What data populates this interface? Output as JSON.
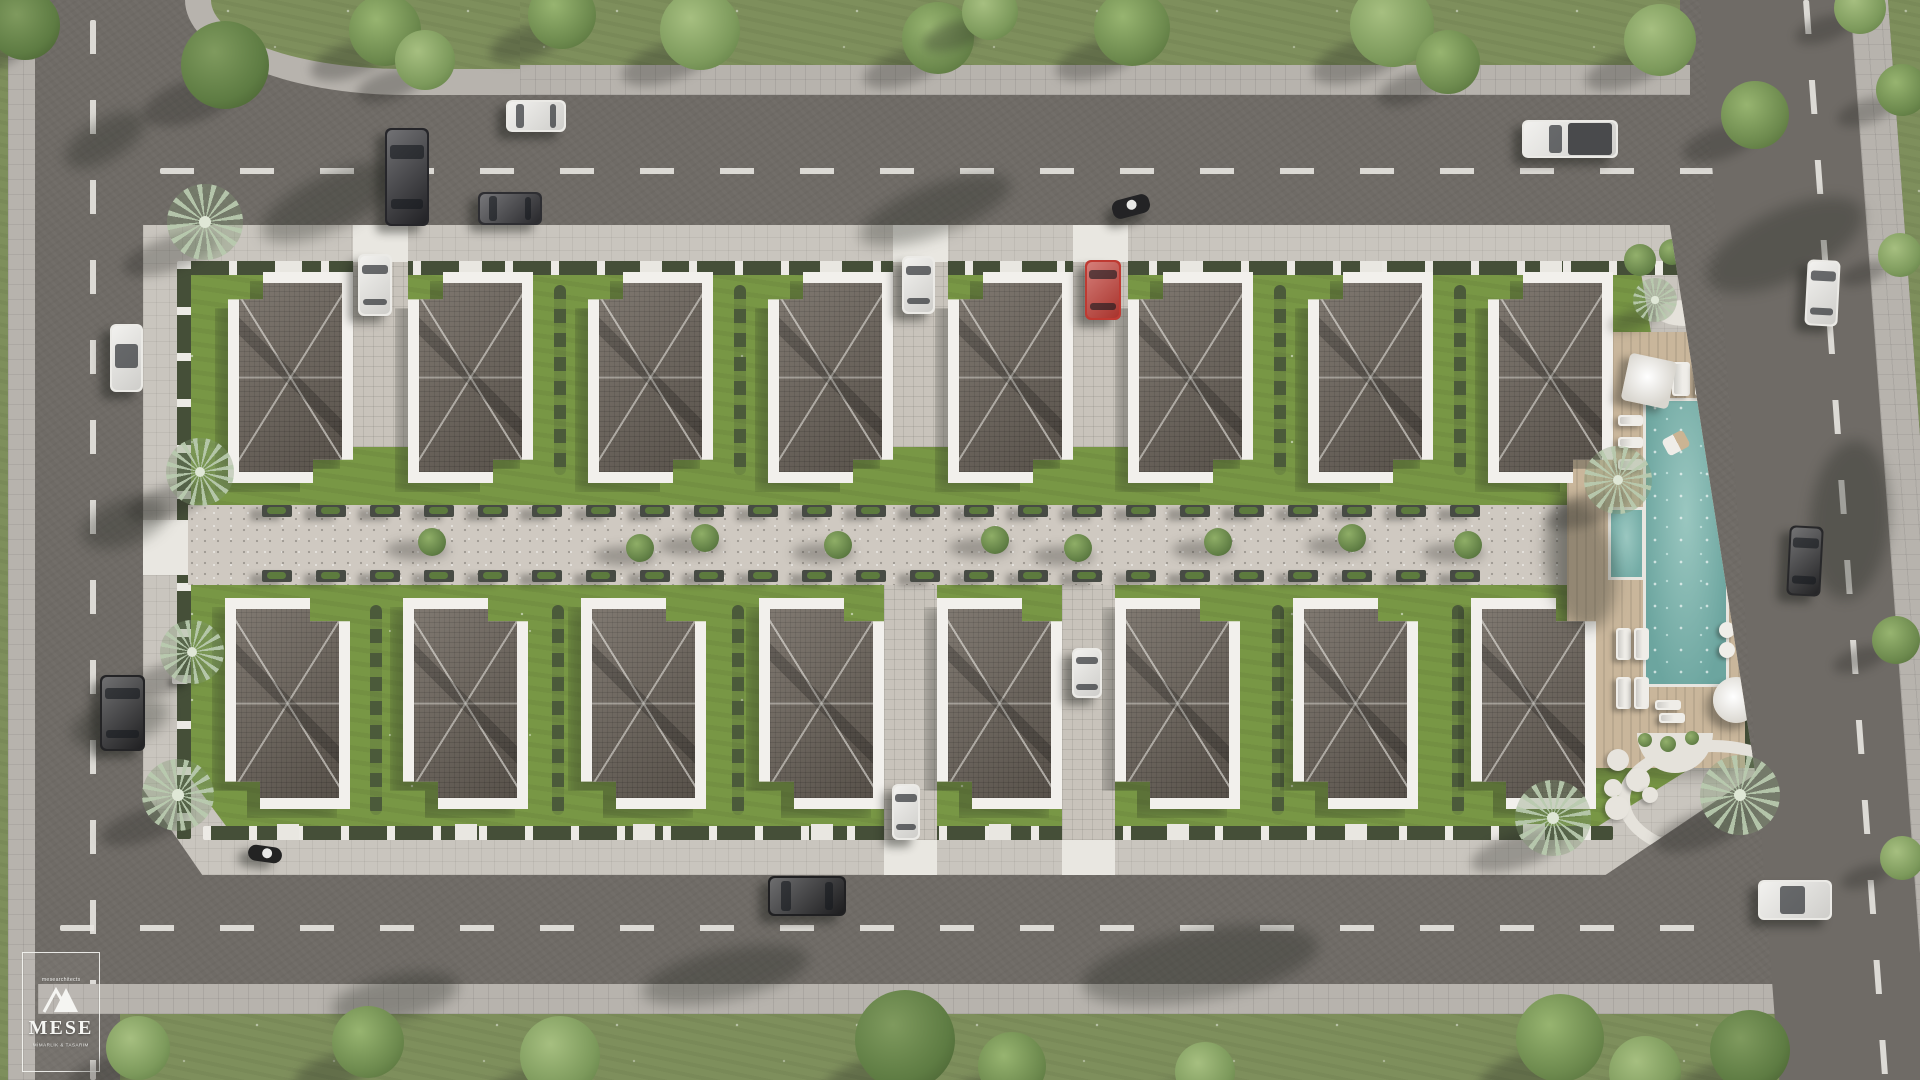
{
  "watermark": {
    "header": "mesearchitects",
    "brand": "MESE",
    "tagline": "MİMARLIK & TASARIM"
  },
  "palette": {
    "asphalt": "#6f6b66",
    "road_dash": "#e8e6e1",
    "sidewalk": "#b7b3ad",
    "ring_sidewalk": "#c9c5be",
    "grass_outer": "#7e8f5c",
    "lawn": "#789745",
    "hedge": "#454f38",
    "fence_post": "#eceae5",
    "roof": "#6e665d",
    "parapet": "#f2f0ec",
    "walkway": "#cfc9c1",
    "planter": "#474b44",
    "deck_wood": "#c9b69b",
    "pool_water": "#7db1ab",
    "car_white": "#ebeae6",
    "car_black": "#26262a",
    "car_red": "#bf3a32",
    "tree_green": "#6d8a4e",
    "palm_green": "#b7c9ad",
    "shadow": "rgba(35,38,32,0.32)"
  },
  "scene": {
    "villas": {
      "w": 125,
      "h": 211,
      "top_row": {
        "y": 272,
        "xs": [
          228,
          408,
          588,
          768,
          948,
          1128,
          1308,
          1488
        ]
      },
      "bottom_row": {
        "y": 598,
        "xs": [
          225,
          403,
          581,
          759,
          937,
          1115,
          1293,
          1471
        ]
      }
    },
    "cars": [
      {
        "x": 385,
        "y": 128,
        "w": 44,
        "h": 98,
        "c": "#26262a",
        "t": "car"
      },
      {
        "x": 478,
        "y": 192,
        "w": 64,
        "h": 33,
        "c": "#2e2e32",
        "t": "car"
      },
      {
        "x": 506,
        "y": 100,
        "w": 60,
        "h": 32,
        "c": "#ebeae6",
        "t": "car"
      },
      {
        "x": 1112,
        "y": 197,
        "w": 38,
        "h": 19,
        "c": "#232325",
        "t": "moto",
        "rot": -15
      },
      {
        "x": 1522,
        "y": 120,
        "w": 96,
        "h": 38,
        "c": "#ebeae6",
        "t": "pickup"
      },
      {
        "x": 1806,
        "y": 260,
        "w": 33,
        "h": 66,
        "c": "#ebeae6",
        "t": "car",
        "rot": 3
      },
      {
        "x": 1788,
        "y": 526,
        "w": 34,
        "h": 70,
        "c": "#28282a",
        "t": "car",
        "rot": 3
      },
      {
        "x": 1758,
        "y": 880,
        "w": 74,
        "h": 40,
        "c": "#ebeae6",
        "t": "conv"
      },
      {
        "x": 768,
        "y": 876,
        "w": 78,
        "h": 40,
        "c": "#202022",
        "t": "car"
      },
      {
        "x": 100,
        "y": 675,
        "w": 45,
        "h": 76,
        "c": "#242426",
        "t": "car"
      },
      {
        "x": 110,
        "y": 324,
        "w": 33,
        "h": 68,
        "c": "#ebeae6",
        "t": "conv"
      },
      {
        "x": 358,
        "y": 254,
        "w": 34,
        "h": 62,
        "c": "#ebeae6",
        "t": "car"
      },
      {
        "x": 902,
        "y": 256,
        "w": 33,
        "h": 58,
        "c": "#ebeae6",
        "t": "car"
      },
      {
        "x": 1085,
        "y": 260,
        "w": 36,
        "h": 60,
        "c": "#bf3a32",
        "t": "car"
      },
      {
        "x": 892,
        "y": 784,
        "w": 28,
        "h": 56,
        "c": "#ebeae6",
        "t": "car"
      },
      {
        "x": 1072,
        "y": 648,
        "w": 30,
        "h": 50,
        "c": "#ebeae6",
        "t": "car"
      },
      {
        "x": 248,
        "y": 846,
        "w": 34,
        "h": 16,
        "c": "#232323",
        "t": "moto",
        "rot": 8
      }
    ],
    "trees": [
      {
        "x": 25,
        "y": 25,
        "r": 35,
        "s": 2
      },
      {
        "x": 225,
        "y": 65,
        "r": 44,
        "s": 2
      },
      {
        "x": 385,
        "y": 30,
        "r": 36,
        "s": 0
      },
      {
        "x": 425,
        "y": 60,
        "r": 30,
        "s": 1
      },
      {
        "x": 562,
        "y": 15,
        "r": 34,
        "s": 0
      },
      {
        "x": 700,
        "y": 30,
        "r": 40,
        "s": 1
      },
      {
        "x": 938,
        "y": 38,
        "r": 36,
        "s": 0
      },
      {
        "x": 990,
        "y": 12,
        "r": 28,
        "s": 1
      },
      {
        "x": 1132,
        "y": 28,
        "r": 38,
        "s": 0
      },
      {
        "x": 1392,
        "y": 25,
        "r": 42,
        "s": 1
      },
      {
        "x": 1448,
        "y": 62,
        "r": 32,
        "s": 0
      },
      {
        "x": 1660,
        "y": 40,
        "r": 36,
        "s": 1
      },
      {
        "x": 1755,
        "y": 115,
        "r": 34,
        "s": 0
      },
      {
        "x": 1860,
        "y": 8,
        "r": 26,
        "s": 1
      },
      {
        "x": 1902,
        "y": 90,
        "r": 26,
        "s": 0
      },
      {
        "x": 1900,
        "y": 255,
        "r": 22,
        "s": 1
      },
      {
        "x": 1896,
        "y": 640,
        "r": 24,
        "s": 0
      },
      {
        "x": 1902,
        "y": 858,
        "r": 22,
        "s": 1
      },
      {
        "x": 138,
        "y": 1048,
        "r": 32,
        "s": 1
      },
      {
        "x": 368,
        "y": 1042,
        "r": 36,
        "s": 0
      },
      {
        "x": 560,
        "y": 1056,
        "r": 40,
        "s": 1
      },
      {
        "x": 905,
        "y": 1040,
        "r": 50,
        "s": 2
      },
      {
        "x": 1012,
        "y": 1066,
        "r": 34,
        "s": 0
      },
      {
        "x": 1205,
        "y": 1072,
        "r": 30,
        "s": 1
      },
      {
        "x": 1560,
        "y": 1038,
        "r": 44,
        "s": 0
      },
      {
        "x": 1645,
        "y": 1072,
        "r": 36,
        "s": 1
      },
      {
        "x": 1750,
        "y": 1050,
        "r": 40,
        "s": 2
      }
    ],
    "palms": [
      {
        "x": 205,
        "y": 222,
        "r": 38
      },
      {
        "x": 200,
        "y": 472,
        "r": 34
      },
      {
        "x": 192,
        "y": 652,
        "r": 32
      },
      {
        "x": 178,
        "y": 795,
        "r": 36
      },
      {
        "x": 1618,
        "y": 480,
        "r": 34
      },
      {
        "x": 1553,
        "y": 818,
        "r": 38
      },
      {
        "x": 1740,
        "y": 795,
        "r": 40
      },
      {
        "x": 1655,
        "y": 300,
        "r": 22
      }
    ],
    "walkway": {
      "planter_start_x": 262,
      "planter_step": 54,
      "planter_count": 23,
      "top_y": 505,
      "bottom_y": 570,
      "trees": [
        {
          "x": 432,
          "y": 542
        },
        {
          "x": 640,
          "y": 548
        },
        {
          "x": 705,
          "y": 538
        },
        {
          "x": 838,
          "y": 545
        },
        {
          "x": 995,
          "y": 540
        },
        {
          "x": 1078,
          "y": 548
        },
        {
          "x": 1218,
          "y": 542
        },
        {
          "x": 1352,
          "y": 538
        },
        {
          "x": 1468,
          "y": 545
        }
      ]
    },
    "driveways": {
      "top_xs": [
        353,
        893,
        1073
      ],
      "bottom_xs": [
        884,
        1062
      ]
    },
    "hedge_columns": {
      "top_xs": [
        560,
        740,
        1280,
        1460
      ],
      "bottom_xs": [
        376,
        558,
        738,
        1278,
        1458
      ]
    },
    "pool": {
      "deck": {
        "x": 1567,
        "y": 332,
        "w": 178,
        "h": 436
      },
      "water": {
        "x": 1643,
        "y": 398,
        "w": 86,
        "h": 289
      },
      "side_pool": {
        "x": 1608,
        "y": 507,
        "w": 37,
        "h": 73
      },
      "float": {
        "x": 1664,
        "y": 434,
        "w": 24,
        "h": 18
      },
      "loungers": [
        {
          "x": 1618,
          "y": 415,
          "w": 25,
          "h": 11
        },
        {
          "x": 1618,
          "y": 437,
          "w": 25,
          "h": 11
        },
        {
          "x": 1618,
          "y": 459,
          "w": 25,
          "h": 11
        },
        {
          "x": 1672,
          "y": 362,
          "w": 18,
          "h": 34
        },
        {
          "x": 1695,
          "y": 362,
          "w": 18,
          "h": 34
        },
        {
          "x": 1616,
          "y": 628,
          "w": 15,
          "h": 32
        },
        {
          "x": 1634,
          "y": 628,
          "w": 15,
          "h": 32
        },
        {
          "x": 1616,
          "y": 677,
          "w": 15,
          "h": 32
        },
        {
          "x": 1634,
          "y": 677,
          "w": 15,
          "h": 32
        },
        {
          "x": 1655,
          "y": 700,
          "w": 26,
          "h": 10
        },
        {
          "x": 1659,
          "y": 713,
          "w": 26,
          "h": 10
        }
      ],
      "umbrellas": [
        {
          "x": 1625,
          "y": 357,
          "d": 48,
          "rot": 12
        },
        {
          "x": 1713,
          "y": 677,
          "d": 46,
          "rot": -8
        },
        {
          "x": 1652,
          "y": 480,
          "d": 0,
          "rot": 0
        }
      ],
      "tables": [
        {
          "x": 1727,
          "y": 630,
          "r": 8
        },
        {
          "x": 1727,
          "y": 650,
          "r": 8
        }
      ],
      "stones": [
        {
          "x": 1618,
          "y": 760,
          "r": 11
        },
        {
          "x": 1638,
          "y": 780,
          "r": 12
        },
        {
          "x": 1613,
          "y": 788,
          "r": 9
        },
        {
          "x": 1617,
          "y": 808,
          "r": 12
        },
        {
          "x": 1650,
          "y": 795,
          "r": 8
        }
      ],
      "pad_bushes": [
        {
          "x": 1645,
          "y": 740,
          "r": 7
        },
        {
          "x": 1668,
          "y": 744,
          "r": 8
        },
        {
          "x": 1692,
          "y": 738,
          "r": 7
        }
      ]
    },
    "ne_garden_bushes": [
      {
        "x": 1640,
        "y": 260,
        "r": 16
      },
      {
        "x": 1672,
        "y": 252,
        "r": 13
      },
      {
        "x": 1700,
        "y": 292,
        "r": 12
      }
    ],
    "road_shadows": [
      {
        "x": 255,
        "y": 175,
        "w": 150,
        "h": 55,
        "rot": -25
      },
      {
        "x": 855,
        "y": 185,
        "w": 160,
        "h": 50,
        "rot": -20
      },
      {
        "x": 60,
        "y": 120,
        "w": 90,
        "h": 40,
        "rot": -30
      },
      {
        "x": 1700,
        "y": 210,
        "w": 170,
        "h": 70,
        "rot": -25
      },
      {
        "x": 80,
        "y": 500,
        "w": 90,
        "h": 45,
        "rot": -20
      },
      {
        "x": 70,
        "y": 700,
        "w": 100,
        "h": 45,
        "rot": -15
      },
      {
        "x": 640,
        "y": 950,
        "w": 170,
        "h": 50,
        "rot": -12
      },
      {
        "x": 1080,
        "y": 930,
        "w": 240,
        "h": 70,
        "rot": -10
      },
      {
        "x": 330,
        "y": 975,
        "w": 130,
        "h": 45,
        "rot": -12
      },
      {
        "x": 1810,
        "y": 440,
        "w": 80,
        "h": 160,
        "rot": 5
      },
      {
        "x": 1545,
        "y": 500,
        "w": 70,
        "h": 130,
        "rot": -10
      }
    ],
    "benches": [
      {
        "x": 172,
        "y": 676,
        "w": 16,
        "h": 8
      }
    ]
  }
}
